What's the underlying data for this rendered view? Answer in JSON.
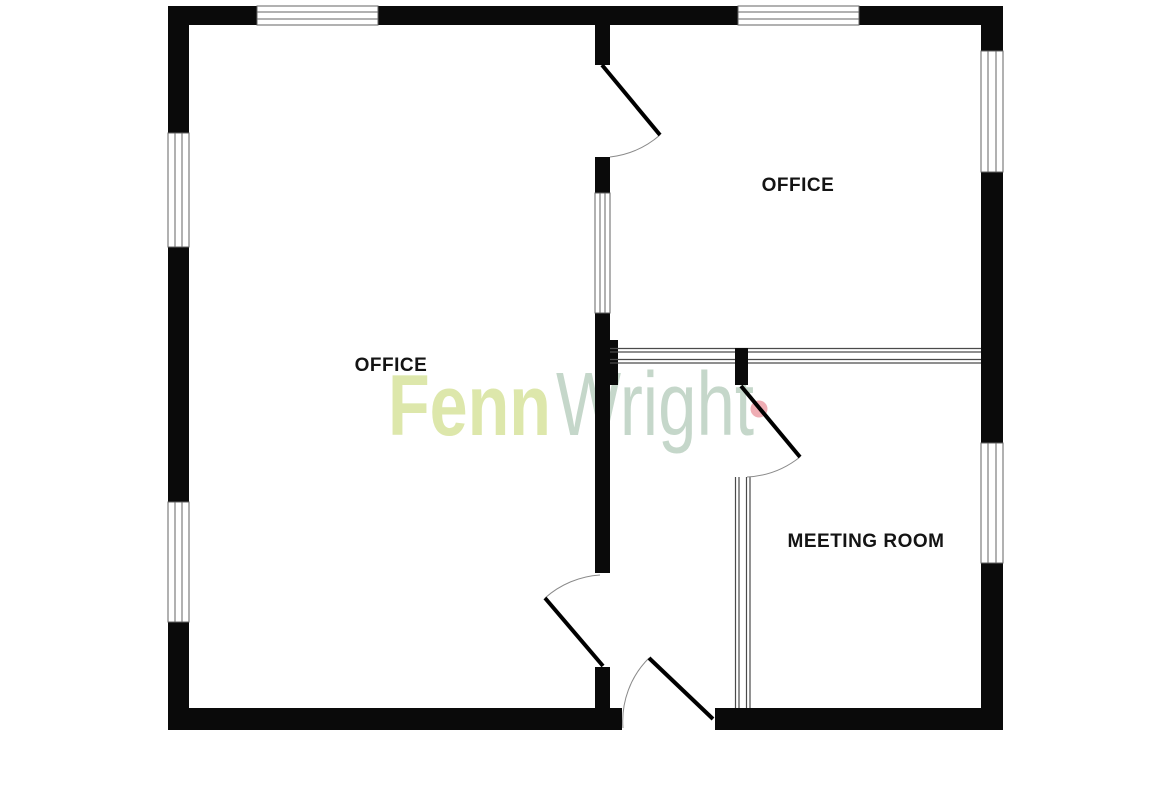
{
  "plan": {
    "wall_color": "#0a0a0a",
    "window_line_color": "#636363",
    "door_leaf_color": "#000000",
    "door_arc_color": "#8a8a8a",
    "partition_line_color": "#4a4a4a",
    "label_color": "#141414",
    "floor_color": "#ffffff"
  },
  "rooms": {
    "office_left": {
      "label": "OFFICE"
    },
    "office_right": {
      "label": "OFFICE"
    },
    "meeting_room": {
      "label": "MEETING ROOM"
    }
  },
  "logo": {
    "fenn": "Fenn",
    "wright": "Wright",
    "fenn_color": "#dde7ab",
    "wright_color": "#c5d7ca",
    "dot_color": "#efadb4"
  }
}
